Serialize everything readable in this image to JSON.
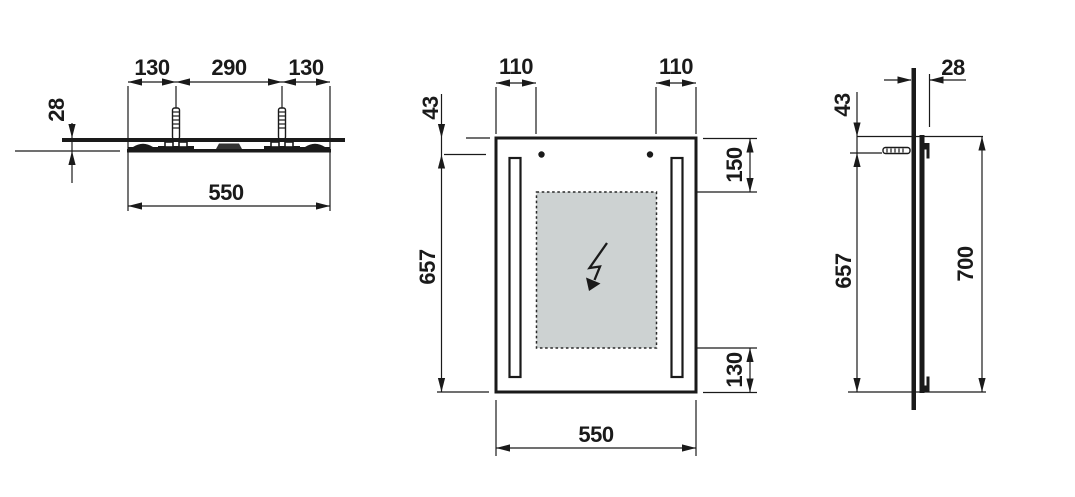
{
  "drawing": {
    "type": "mirror-installation-technical-drawing",
    "colors": {
      "line": "#1a1a1a",
      "heater_pad_fill": "#cdd2d2",
      "background": "#ffffff"
    },
    "icons": {
      "anchor": "wall-plug-icon",
      "power": "lightning-bolt-icon"
    },
    "top_view": {
      "dim_left_hole": "130",
      "dim_hole_spacing": "290",
      "dim_right_hole": "130",
      "dim_depth": "28",
      "dim_width": "550"
    },
    "front_view": {
      "dim_hole_inset_left": "110",
      "dim_hole_inset_right": "110",
      "dim_top_to_hole": "43",
      "dim_hole_to_bottom": "657",
      "dim_top_to_heater": "150",
      "dim_heater_to_bottom": "130",
      "dim_width": "550"
    },
    "side_view": {
      "dim_depth": "28",
      "dim_top_to_hole": "43",
      "dim_hole_to_bottom": "657",
      "dim_height": "700"
    }
  }
}
